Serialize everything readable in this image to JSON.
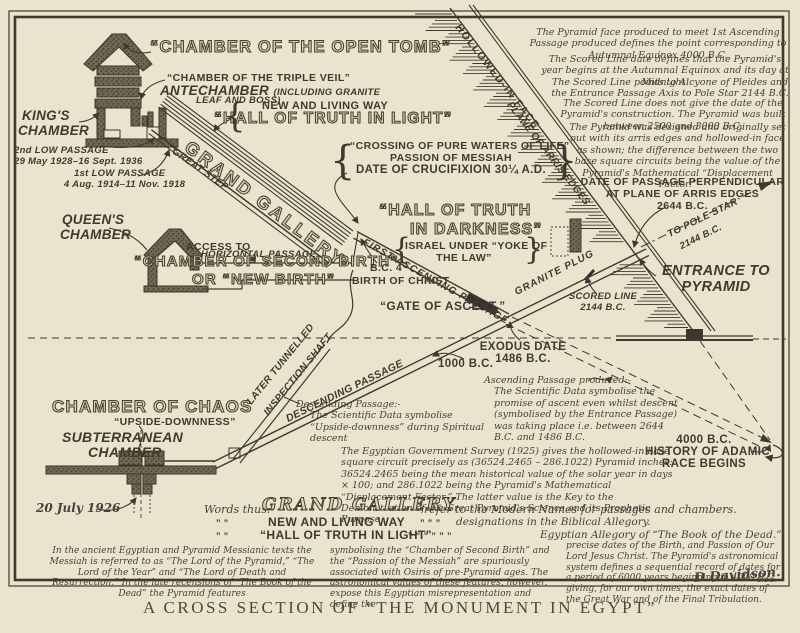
{
  "colors": {
    "paper": "#eae3cd",
    "ink": "#3f3a2f",
    "outline_fill": "#ddd4b9"
  },
  "caption": "A CROSS SECTION OF “THE MONUMENT IN EGYPT”",
  "glyphs": {
    "brace_l": "{",
    "brace_r": "}"
  },
  "labels": {
    "open_tomb": "“CHAMBER OF THE OPEN TOMB”",
    "triple_veil": "“CHAMBER OF THE TRIPLE VEIL”",
    "antechamber": "ANTECHAMBER",
    "antechamber_p1": "(INCLUDING GRANITE",
    "antechamber_p2": "LEAF AND BOSS)",
    "new_living_way": "NEW AND LIVING WAY",
    "hall_truth_light": "“HALL OF TRUTH IN LIGHT”",
    "kings_1": "KING'S",
    "kings_2": "CHAMBER",
    "low2_1": "2nd LOW PASSAGE",
    "low2_2": "29 May 1928–16 Sept. 1936",
    "low1_1": "1st LOW PASSAGE",
    "low1_2": "4 Aug. 1914–11 Nov. 1918",
    "great_step": "GREAT STEP",
    "grand_gallery": "GRAND GALLERY",
    "crossing_1": "“CROSSING OF PURE WATERS OF LIFE”",
    "crossing_2": "PASSION OF MESSIAH",
    "crossing_3": "DATE OF CRUCIFIXION 30¼ A.D.",
    "hall_dark_1": "“HALL OF TRUTH",
    "hall_dark_2": "IN DARKNESS”",
    "israel_1": "ISRAEL UNDER “YOKE OF",
    "israel_2": "THE LAW”",
    "queens_1": "QUEEN'S",
    "queens_2": "CHAMBER",
    "horizontal_passage": "HORIZONTAL PASSAGE",
    "access_to": "ACCESS TO",
    "second_birth_1": "“CHAMBER OF SECOND BIRTH”",
    "second_birth_2": "OR “NEW BIRTH”",
    "first_ascending": "FIRST ASCENDING PASSAGE",
    "bc4_1": "B.C. 4",
    "bc4_2": "BIRTH OF CHRIST",
    "gate_of_ascent": "“GATE OF ASCENT.”",
    "granite_plug": "GRANITE PLUG",
    "scored_1": "SCORED LINE",
    "scored_2": "2144 B.C.",
    "exodus_1": "EXODUS DATE",
    "exodus_2": "1486 B.C.",
    "bc1000": "1000 B.C.",
    "entrance_1": "ENTRANCE TO",
    "entrance_2": "PYRAMID",
    "pole_star_1": "TO POLE STAR",
    "pole_star_2": "2144 B.C.",
    "date_perp_1": "DATE OF PASSAGE PERPENDICULAR",
    "date_perp_2": "AT PLANE OF ARRIS EDGES",
    "date_perp_3": "2644 B.C.",
    "hollowed_face": "HOLLOWED-IN FACE",
    "arris_edges": "PLANE OF ARRIS EDGES",
    "chaos_1": "CHAMBER OF CHAOS",
    "chaos_2": "“UPSIDE-DOWNNESS”",
    "subterranean_1": "SUBTERRANEAN",
    "subterranean_2": "CHAMBER",
    "tunnelled_1": "LATER TUNNELLED",
    "tunnelled_2": "INSPECTION SHAFT",
    "descending_passage": "DESCENDING PASSAGE",
    "july_1926": "20 July 1926",
    "adamic_1": "4000 B.C.",
    "adamic_2": "HISTORY OF ADAMIC",
    "adamic_3": "RACE BEGINS"
  },
  "notes": {
    "face_produced": "The Pyramid face produced to meet 1st Ascending Passage produced defines the point corresponding to Autumnal Equinox 4000 B.C.",
    "scored_date": "The Scored Line date defines that the Pyramid's year begins at the Autumnal Equinox and its day at Midnight.",
    "scored_points": "The Scored Line points to Alcyone of Pleides and the Entrance Passage Axis to Pole Star 2144 B.C.",
    "scored_construction": "The Scored Line does not give the date of the Pyramid's construction. The Pyramid was built between 2500 and 3000 B.C.",
    "designed": "The Pyramid was designed and originally set out with its arris edges and hollowed-in face as shown; the difference between the two base square circuits being the value of the Pyramid's Mathematical “Displacement Factor.”",
    "asc_title": "Ascending Passage produced:-",
    "asc_body": "The Scientific Data symbolise the promise of ascent even whilst descent (symbolised by the Entrance Passage) was taking place i.e. between 2644 B.C. and 1486 B.C.",
    "desc_title": "Descending Passage:-",
    "desc_body": "The Scientific Data symbolise “Upside-downness” during Spiritual descent",
    "survey": "The Egyptian Government Survey (1925) gives the hollowed-in base square circuit precisely as (36524.2465 – 286.1022) Pyramid inches: 36524.2465 being the mean historical value of the solar year in days × 100; and 286.1022 being the Pyramid's Mathematical “Displacement Factor.” The latter value is the Key to the Demonstration of the Great Pyramid's Science and its Prophetic Purpose.",
    "footer_1": "In the ancient Egyptian and Pyramid Messianic texts the Messiah is referred to as “The Lord of the Pyramid,” “The Lord of the Year” and “The Lord of Death and Resurrection.”  In the late recensions of “The Book of the Dead” the Pyramid features",
    "footer_2": "symbolising the “Chamber of Second Birth” and the “Passion of the Messiah” are spuriously associated with Osiris of pre-Pyramid ages. The astronomical values of these features, however, expose this Egyptian misrepresentation and define the",
    "footer_3": "precise dates of the Birth, and Passion of Our Lord Jesus Christ. The Pyramid's astronomical system defines a sequential record of dates for a period of 6000 years beginning in 4000 B.C., giving, for our own times, the exact dates of the Great War and of the Final Tribulation.",
    "signature": "D.Davidson.",
    "initials": "D.C.D."
  },
  "legend": {
    "words_thus": "Words thus:-",
    "row1_term": "GRAND GALLERY",
    "row1_rest": "refer to the Modern Names for passages and chambers.",
    "ditto2_l": "”      ”",
    "row2_term": "NEW AND LIVING WAY",
    "ditto2_m": "”   ”   ”",
    "row2_rest": "designations in the Biblical Allegory.",
    "ditto3_l": "”      ”",
    "row3_term": "“HALL OF TRUTH IN LIGHT”",
    "ditto3_m": "”   ”   ”     ”      ”   ”",
    "row3_rest": "Egyptian Allegory of “The Book of the Dead.”"
  }
}
